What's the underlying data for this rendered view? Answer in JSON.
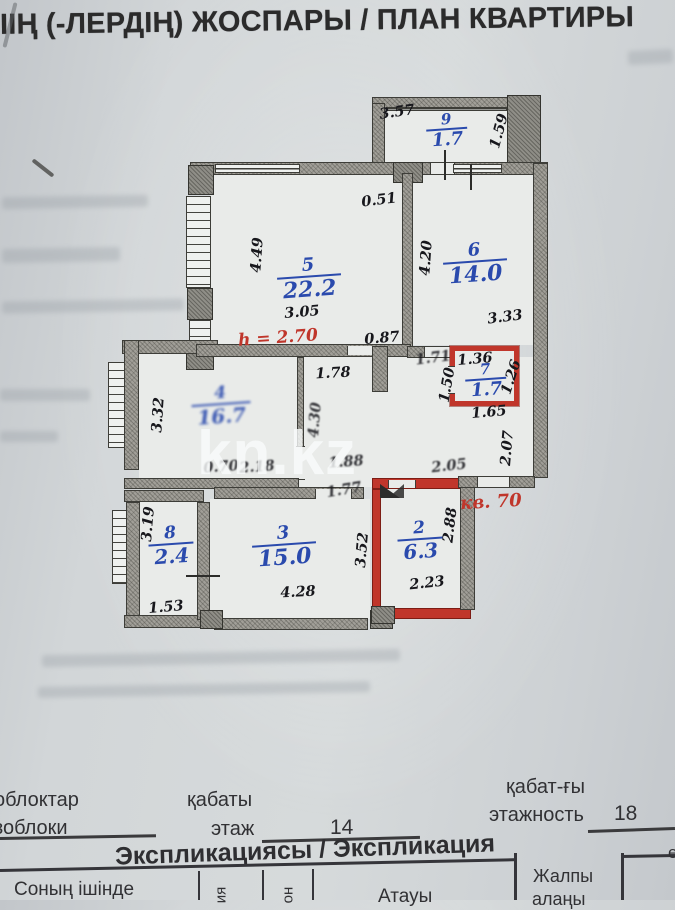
{
  "title": "ІІҢ (-ЛЕРДІҢ) ЖОСПАРЫ / ПЛАН КВАРТИРЫ",
  "watermark": "kn.kz",
  "colors": {
    "accent_blue": "#2a4aad",
    "accent_red": "#c0362b",
    "wall_gray": "#a19f98"
  },
  "plan": {
    "rooms": [
      {
        "num": "9",
        "area": "1.7",
        "x": 447,
        "y": 131,
        "sz": "sm",
        "blur": false
      },
      {
        "num": "5",
        "area": "22.2",
        "x": 309,
        "y": 279,
        "sz": "lg",
        "blur": false
      },
      {
        "num": "6",
        "area": "14.0",
        "x": 475,
        "y": 264,
        "sz": "lg",
        "blur": false
      },
      {
        "num": "7",
        "area": "1.7",
        "x": 486,
        "y": 381,
        "sz": "sm",
        "blur": false
      },
      {
        "num": "4",
        "area": "16.7",
        "x": 221,
        "y": 406,
        "sz": "md",
        "blur": true
      },
      {
        "num": "8",
        "area": "2.4",
        "x": 171,
        "y": 546,
        "sz": "md",
        "blur": false
      },
      {
        "num": "3",
        "area": "15.0",
        "x": 284,
        "y": 547,
        "sz": "lg",
        "blur": false
      },
      {
        "num": "2",
        "area": "6.3",
        "x": 420,
        "y": 541,
        "sz": "md",
        "blur": false
      }
    ],
    "dims": [
      {
        "t": "3.57",
        "x": 397,
        "y": 112,
        "r": -8,
        "s": false
      },
      {
        "t": "1.59",
        "x": 499,
        "y": 131,
        "r": -75,
        "s": false
      },
      {
        "t": "0.51",
        "x": 379,
        "y": 200,
        "r": -7,
        "s": false
      },
      {
        "t": "4.49",
        "x": 257,
        "y": 255,
        "r": -86,
        "s": false
      },
      {
        "t": "3.05",
        "x": 302,
        "y": 312,
        "r": -5,
        "s": false
      },
      {
        "t": "0.87",
        "x": 382,
        "y": 338,
        "r": -5,
        "s": false
      },
      {
        "t": "4.20",
        "x": 426,
        "y": 258,
        "r": -86,
        "s": false
      },
      {
        "t": "3.33",
        "x": 505,
        "y": 317,
        "r": -7,
        "s": false
      },
      {
        "t": "1.71",
        "x": 433,
        "y": 358,
        "r": -7,
        "s": true
      },
      {
        "t": "1.36",
        "x": 475,
        "y": 359,
        "r": -5,
        "s": false
      },
      {
        "t": "1.26",
        "x": 511,
        "y": 377,
        "r": -72,
        "s": false
      },
      {
        "t": "1.50",
        "x": 447,
        "y": 385,
        "r": -80,
        "s": false
      },
      {
        "t": "1.65",
        "x": 489,
        "y": 412,
        "r": -5,
        "s": false
      },
      {
        "t": "2.07",
        "x": 507,
        "y": 448,
        "r": -85,
        "s": false
      },
      {
        "t": "1.78",
        "x": 333,
        "y": 373,
        "r": -3,
        "s": false
      },
      {
        "t": "4.30",
        "x": 315,
        "y": 420,
        "r": -85,
        "s": true
      },
      {
        "t": "3.32",
        "x": 158,
        "y": 415,
        "r": -86,
        "s": false
      },
      {
        "t": "0.70",
        "x": 221,
        "y": 467,
        "r": -4,
        "s": true
      },
      {
        "t": "2.18",
        "x": 257,
        "y": 467,
        "r": -4,
        "s": true
      },
      {
        "t": "1.88",
        "x": 346,
        "y": 462,
        "r": -4,
        "s": true
      },
      {
        "t": "2.05",
        "x": 449,
        "y": 466,
        "r": -6,
        "s": true
      },
      {
        "t": "1.77",
        "x": 344,
        "y": 490,
        "r": -9,
        "s": true
      },
      {
        "t": "2.88",
        "x": 450,
        "y": 525,
        "r": -83,
        "s": false
      },
      {
        "t": "3.19",
        "x": 148,
        "y": 524,
        "r": -85,
        "s": false
      },
      {
        "t": "1.53",
        "x": 166,
        "y": 607,
        "r": -5,
        "s": false
      },
      {
        "t": "4.28",
        "x": 298,
        "y": 592,
        "r": -3,
        "s": false
      },
      {
        "t": "3.52",
        "x": 362,
        "y": 550,
        "r": -85,
        "s": false
      },
      {
        "t": "2.23",
        "x": 427,
        "y": 583,
        "r": -6,
        "s": false
      }
    ],
    "notes": [
      {
        "t": "h = 2.70",
        "x": 278,
        "y": 338,
        "r": -4,
        "fs": 17
      },
      {
        "t": "кв. 70",
        "x": 491,
        "y": 502,
        "r": -3,
        "fs": 18
      }
    ]
  },
  "decor": {
    "smudges": [
      {
        "x": 628,
        "y": 50,
        "w": 45,
        "h": 14,
        "r": -3
      },
      {
        "x": 2,
        "y": 196,
        "w": 146,
        "h": 12,
        "r": -1
      },
      {
        "x": 2,
        "y": 248,
        "w": 118,
        "h": 14,
        "r": -1
      },
      {
        "x": 2,
        "y": 300,
        "w": 182,
        "h": 12,
        "r": -1
      },
      {
        "x": 0,
        "y": 389,
        "w": 90,
        "h": 12,
        "r": 0
      },
      {
        "x": 0,
        "y": 431,
        "w": 58,
        "h": 11,
        "r": 0
      },
      {
        "x": 42,
        "y": 652,
        "w": 358,
        "h": 12,
        "r": -1
      },
      {
        "x": 38,
        "y": 684,
        "w": 332,
        "h": 11,
        "r": -1
      }
    ]
  },
  "footer": {
    "block_kk": "облоктар",
    "block_ru": "зоблоки",
    "floor_kk": "қабаты",
    "floor_ru": "этаж",
    "floor_value": "14",
    "storeys_kk": "қабат-ғы",
    "storeys_ru": "этажность",
    "storeys_value": "18"
  },
  "table": {
    "title": "Экспликациясы / Экспликация",
    "col_within": "Соның ішінде",
    "col_rot_1": "ия",
    "col_rot_2": "он",
    "col_name": "Атауы",
    "col_total_1": "Жалпы",
    "col_total_2": "алаңы",
    "col_partial": "е"
  }
}
